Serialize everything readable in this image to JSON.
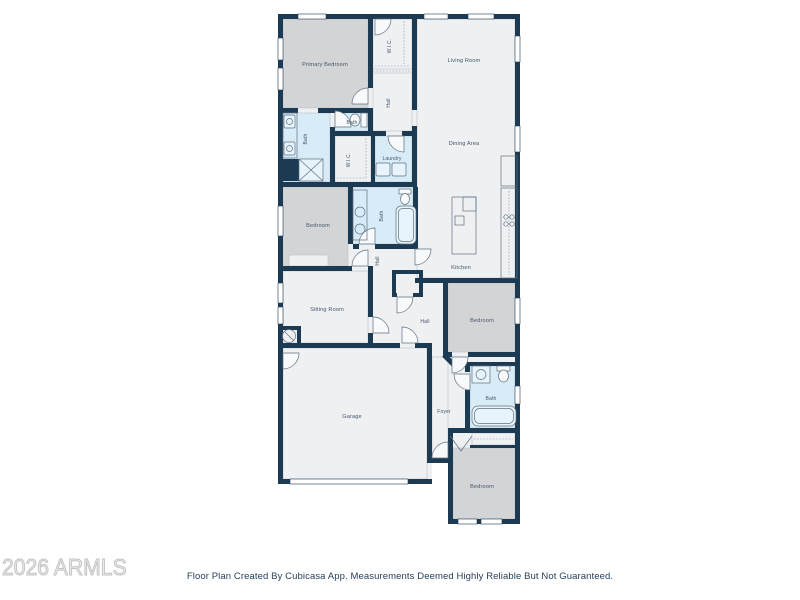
{
  "watermark": "2026 ARMLS",
  "caption": "Floor Plan Created By Cubicasa App. Measurements Deemed Highly Reliable But Not Guaranteed.",
  "colors": {
    "wall": "#1d3a53",
    "room_gray": "#d3d4d6",
    "room_light": "#eef0f2",
    "room_blue": "#d8ecf8",
    "label_text": "#44566a",
    "caption_text": "#29405a",
    "watermark_gray": "#c3c3c3"
  },
  "floorplan": {
    "rooms": {
      "primary_bedroom": "Primary Bedroom",
      "wic_top": "W.I.C.",
      "hall_top": "Hall",
      "living_room": "Living Room",
      "primary_bath": "Bath",
      "powder_bath": "Bath",
      "wic_mid": "W.I.C.",
      "laundry": "Laundry",
      "dining_area": "Dining Area",
      "bedroom_left": "Bedroom",
      "bath_mid": "Bath",
      "hall_mid": "Hall",
      "kitchen": "Kitchen",
      "sitting_room": "Sitting Room",
      "hall_lower": "Hall",
      "bedroom_right": "Bedroom",
      "bath_right": "Bath",
      "garage": "Garage",
      "foyer": "Foyer",
      "bedroom_bottom": "Bedroom"
    }
  }
}
